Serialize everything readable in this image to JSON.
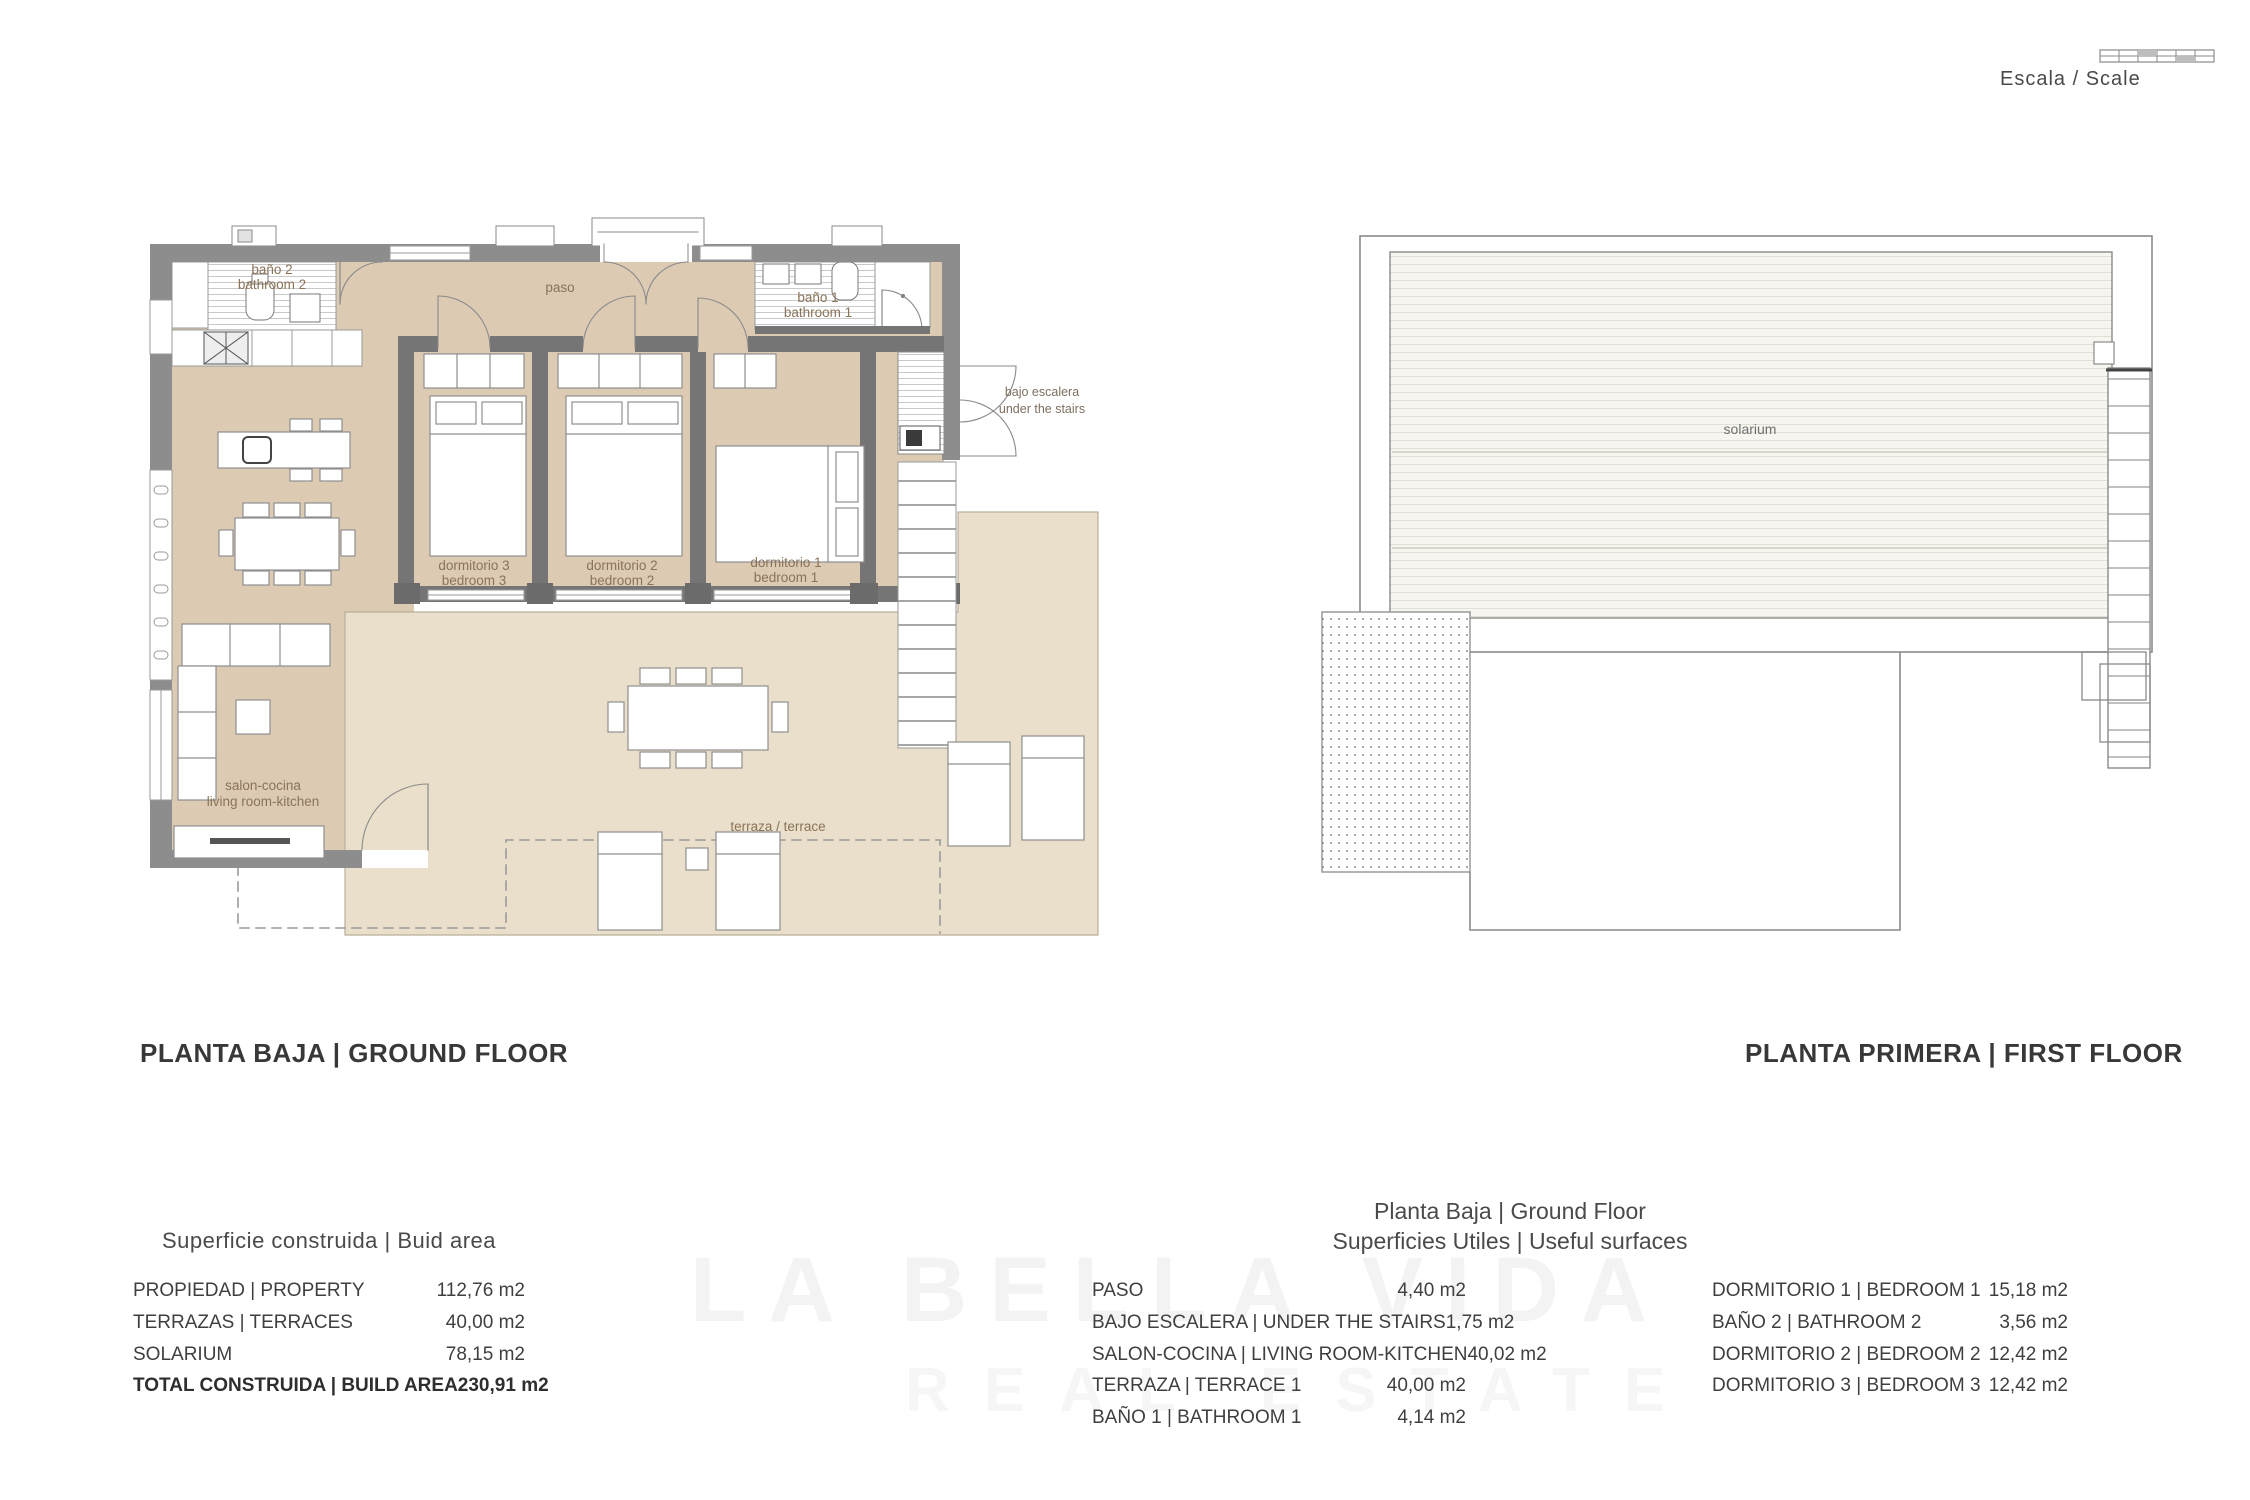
{
  "scale_indicator": {
    "label": "Escala / Scale"
  },
  "ground_floor": {
    "title": "PLANTA BAJA | GROUND FLOOR",
    "rooms": {
      "bano2": {
        "line1": "baño 2",
        "line2": "bathroom 2"
      },
      "paso": {
        "line1": "paso"
      },
      "bano1": {
        "line1": "baño 1",
        "line2": "bathroom 1"
      },
      "dorm3": {
        "line1": "dormitorio 3",
        "line2": "bedroom 3"
      },
      "dorm2": {
        "line1": "dormitorio 2",
        "line2": "bedroom 2"
      },
      "dorm1": {
        "line1": "dormitorio 1",
        "line2": "bedroom 1"
      },
      "salon": {
        "line1": "salon-cocina",
        "line2": "living room-kitchen"
      },
      "terraza": {
        "line1": "terraza / terrace"
      },
      "bajo_escalera": {
        "line1": "bajo escalera",
        "line2": "under the stairs"
      }
    }
  },
  "first_floor": {
    "title": "PLANTA PRIMERA | FIRST FLOOR",
    "rooms": {
      "solarium": {
        "line1": "solarium"
      }
    }
  },
  "build_area_table": {
    "title": "Superficie construida | Buid area",
    "rows": [
      {
        "label": "PROPIEDAD | PROPERTY",
        "value": "112,76 m2"
      },
      {
        "label": "TERRAZAS | TERRACES",
        "value": "40,00 m2"
      },
      {
        "label": "SOLARIUM",
        "value": "78,15 m2"
      },
      {
        "label": "TOTAL CONSTRUIDA | BUILD AREA",
        "value": "230,91 m2"
      }
    ]
  },
  "useful_surfaces_table": {
    "heading_line1": "Planta Baja | Ground Floor",
    "heading_line2": "Superficies Utiles | Useful surfaces",
    "left_rows": [
      {
        "label": "PASO",
        "value": "4,40 m2"
      },
      {
        "label": "BAJO ESCALERA | UNDER THE STAIRS",
        "value": "1,75 m2"
      },
      {
        "label": "SALON-COCINA | LIVING ROOM-KITCHEN",
        "value": "40,02 m2"
      },
      {
        "label": "TERRAZA | TERRACE 1",
        "value": "40,00 m2"
      },
      {
        "label": "BAÑO 1 | BATHROOM 1",
        "value": "4,14 m2"
      }
    ],
    "right_rows": [
      {
        "label": "DORMITORIO 1 | BEDROOM 1",
        "value": "15,18 m2"
      },
      {
        "label": "BAÑO 2 | BATHROOM 2",
        "value": "3,56 m2"
      },
      {
        "label": "DORMITORIO 2 | BEDROOM 2",
        "value": "12,42 m2"
      },
      {
        "label": "DORMITORIO 3 | BEDROOM 3",
        "value": "12,42 m2"
      }
    ]
  },
  "watermark": {
    "line1": "LA BELLA VIDA",
    "line2": "REAL ESTATE"
  },
  "colors": {
    "wall": "#8d8d8d",
    "inner_wall": "#757575",
    "floor": "#dccab3",
    "terrace": "#eadfca",
    "label_brown": "#8a7358"
  }
}
